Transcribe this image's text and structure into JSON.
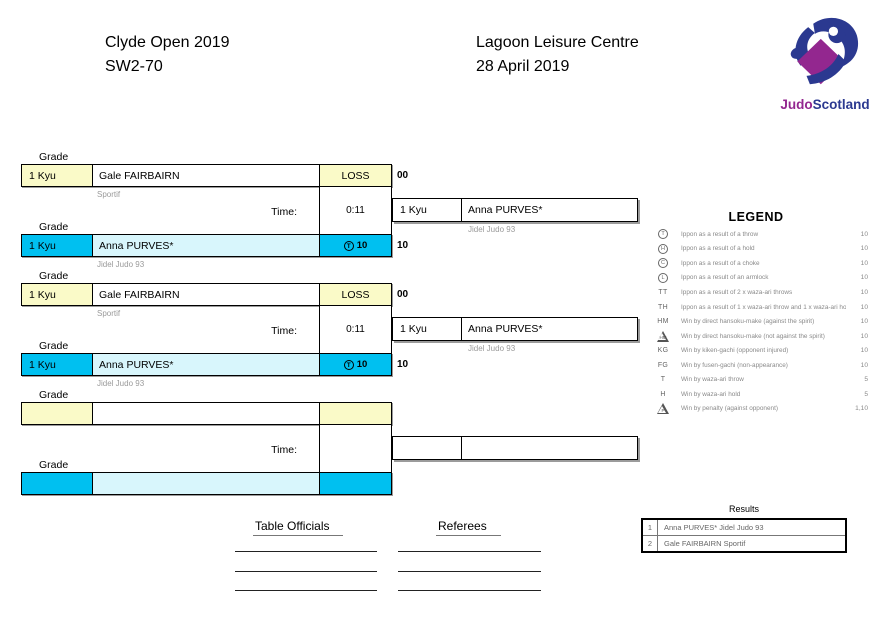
{
  "header": {
    "event": "Clyde Open 2019",
    "category": "SW2-70",
    "venue": "Lagoon Leisure Centre",
    "date": "28 April 2019"
  },
  "logo": {
    "judo": "Judo",
    "scotland": "Scotland"
  },
  "labels": {
    "grade": "Grade",
    "time": "Time:"
  },
  "colors": {
    "pale_yellow": "#FAFAC8",
    "cyan": "#00C0F0",
    "light_cyan": "#D8F6FC",
    "logo_blue": "#2B3990",
    "logo_purple": "#93278F"
  },
  "matches": [
    {
      "top": {
        "grade": "1 Kyu",
        "name": "Gale FAIRBAIRN",
        "club": "Sportif",
        "result": "LOSS",
        "score": "00"
      },
      "time": "0:11",
      "bottom": {
        "grade": "1 Kyu",
        "name": "Anna PURVES*",
        "club": "Jidel Judo 93",
        "result_symbol": "T",
        "result_value": "10",
        "score": "10"
      },
      "winner": {
        "grade": "1 Kyu",
        "name": "Anna PURVES*",
        "club": "Jidel Judo 93"
      }
    },
    {
      "top": {
        "grade": "1 Kyu",
        "name": "Gale FAIRBAIRN",
        "club": "Sportif",
        "result": "LOSS",
        "score": "00"
      },
      "time": "0:11",
      "bottom": {
        "grade": "1 Kyu",
        "name": "Anna PURVES*",
        "club": "Jidel Judo 93",
        "result_symbol": "T",
        "result_value": "10",
        "score": "10"
      },
      "winner": {
        "grade": "1 Kyu",
        "name": "Anna PURVES*",
        "club": "Jidel Judo 93"
      }
    },
    {
      "top": {
        "grade": "",
        "name": "",
        "club": "",
        "result": "",
        "score": ""
      },
      "time": "",
      "bottom": {
        "grade": "",
        "name": "",
        "club": "",
        "result_symbol": "",
        "result_value": "",
        "score": ""
      },
      "winner": {
        "grade": "",
        "name": "",
        "club": ""
      }
    }
  ],
  "legend": {
    "title": "LEGEND",
    "rows": [
      {
        "symbol": "T",
        "style": "circle",
        "text": "Ippon as a result of a throw",
        "points": "10"
      },
      {
        "symbol": "H",
        "style": "circle",
        "text": "Ippon as a result of a hold",
        "points": "10"
      },
      {
        "symbol": "C",
        "style": "circle",
        "text": "Ippon as a result of a choke",
        "points": "10"
      },
      {
        "symbol": "L",
        "style": "circle",
        "text": "Ippon as a result of an armlock",
        "points": "10"
      },
      {
        "symbol": "TT",
        "style": "text",
        "text": "Ippon as a result of 2 x waza-ari throws",
        "points": "10"
      },
      {
        "symbol": "TH",
        "style": "text",
        "text": "Ippon as a result of 1 x waza-ari throw and 1 x waza-ari hold",
        "points": "10"
      },
      {
        "symbol": "HM",
        "style": "text",
        "text": "Win by direct hansoku-make (against the spirit)",
        "points": "10"
      },
      {
        "symbol": "HM",
        "style": "triangle",
        "text": "Win by direct hansoku-make (not against the spirit)",
        "points": "10"
      },
      {
        "symbol": "KG",
        "style": "text",
        "text": "Win by kiken-gachi (opponent injured)",
        "points": "10"
      },
      {
        "symbol": "FG",
        "style": "text",
        "text": "Win by fusen-gachi (non-appearance)",
        "points": "10"
      },
      {
        "symbol": "T",
        "style": "text",
        "text": "Win by waza-ari throw",
        "points": "5"
      },
      {
        "symbol": "H",
        "style": "text",
        "text": "Win by waza-ari hold",
        "points": "5"
      },
      {
        "symbol": "P",
        "style": "triangle",
        "text": "Win by penalty (against opponent)",
        "points": "1,10"
      }
    ]
  },
  "results": {
    "title": "Results",
    "rows": [
      {
        "position": "1",
        "competitor": "Anna PURVES* Jidel Judo 93"
      },
      {
        "position": "2",
        "competitor": "Gale FAIRBAIRN Sportif"
      }
    ]
  },
  "signatures": {
    "table_officials": "Table Officials",
    "referees": "Referees"
  }
}
